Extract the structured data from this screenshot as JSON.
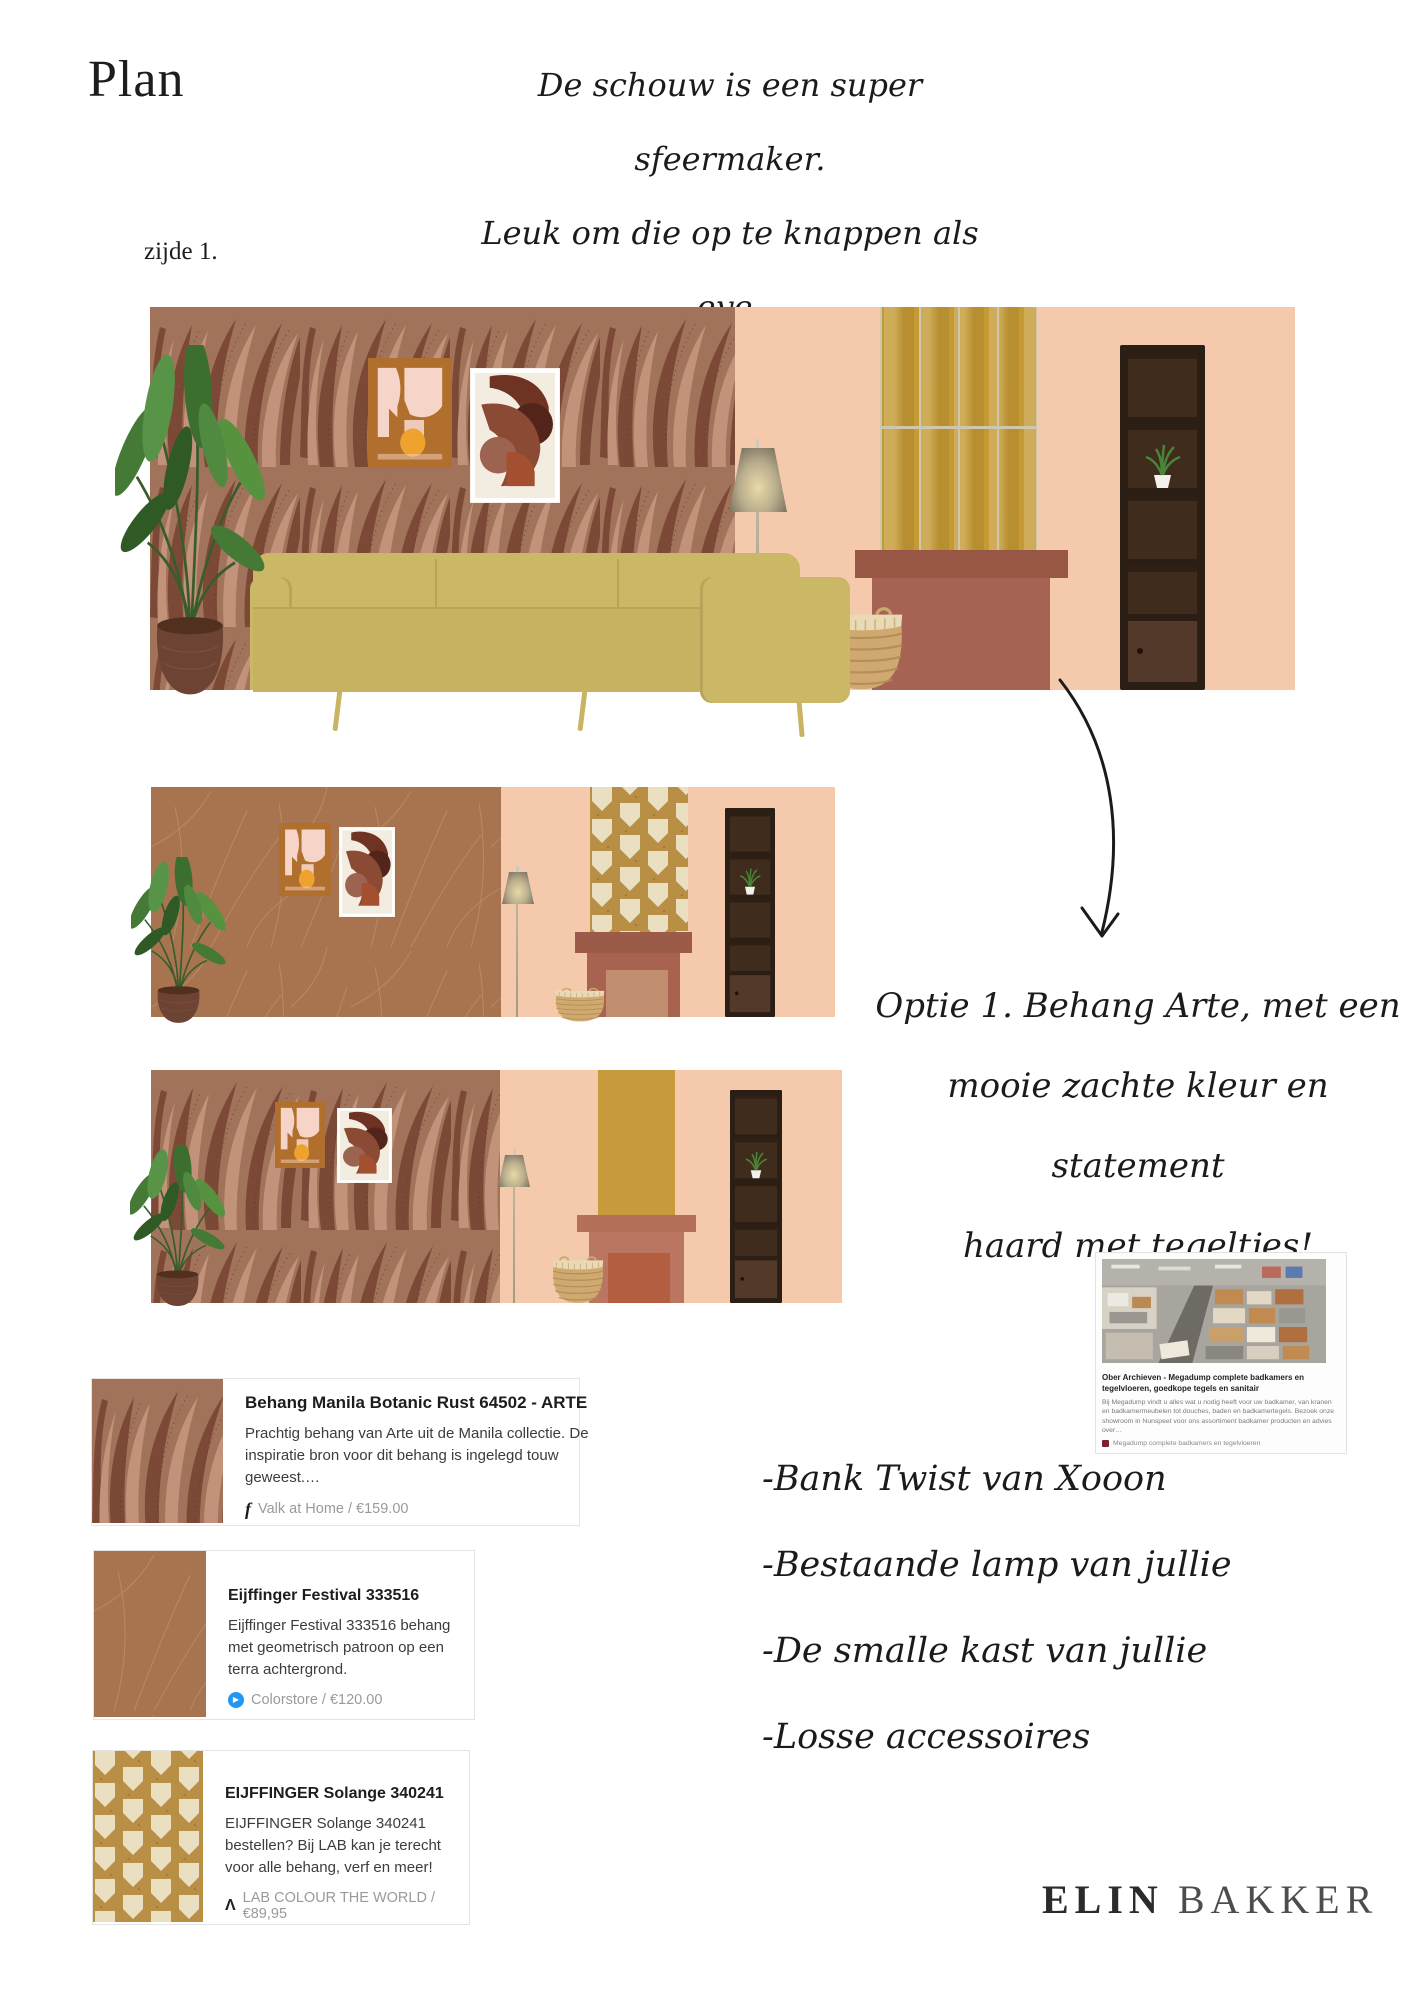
{
  "page": {
    "title": "Plan",
    "side_label": "zijde 1."
  },
  "notes": {
    "fireplace_note": {
      "lines": [
        "De schouw is een super sfeermaker.",
        "Leuk om die op te knappen als eye-",
        "catcher in de kamer!"
      ]
    },
    "option_note": {
      "lines": [
        "Optie 1. Behang Arte, met een",
        "mooie zachte kleur en statement",
        "haard met tegeltjes!"
      ]
    },
    "sourcing_list": {
      "items": [
        "-Bank Twist van Xooon",
        "-Bestaande lamp van jullie",
        "-De smalle kast van jullie",
        "-Losse accessoires"
      ]
    }
  },
  "products": [
    {
      "title": "Behang Manila Botanic Rust 64502 - ARTE",
      "description": "Prachtig behang van Arte uit de Manila collectie. De inspiratie bron voor dit behang is ingelegd touw geweest.…",
      "vendor": "Valk at Home",
      "price": "€159.00",
      "source_line": "Valk at Home / €159.00"
    },
    {
      "title": "Eijffinger Festival 333516",
      "description": "Eijffinger Festival 333516 behang met geometrisch patroon op een terra achtergrond.",
      "vendor": "Colorstore",
      "price": "€120.00",
      "source_line": "Colorstore / €120.00"
    },
    {
      "title": "EIJFFINGER Solange 340241",
      "description": "EIJFFINGER Solange 340241 bestellen? Bij LAB kan je terecht voor alle behang, verf en meer!",
      "vendor": "LAB COLOUR THE WORLD",
      "price": "€89,95",
      "source_line": "LAB COLOUR THE WORLD / €89,95"
    }
  ],
  "icons": {
    "facebook": "f",
    "colorstore": "▶",
    "lab": "Λ"
  },
  "web_snippet": {
    "title": "Ober Archieven - Megadump complete badkamers en tegelvloeren, goedkope tegels en sanitair",
    "description": "Bij Megadump vindt u alles wat u nodig heeft voor uw badkamer, van kranen en badkamermeubelen tot douches, baden en badkamertegels. Bezoek onze showroom in Nunspeet voor ons assortiment badkamer producten en advies over…",
    "source": "Megadump complete badkamers en tegelvloeren"
  },
  "brand": {
    "first_name": "ELIN",
    "last_name": "BAKKER"
  },
  "colors": {
    "peach": "#f4c9ac",
    "manila_base": "#a1735a",
    "manila_leaf_dark": "#7d4937",
    "festival_terracotta": "#a8744f",
    "solange_gold": "#b98f45",
    "tile_gold": "#c59a34",
    "fireplace_terracotta": "#9d5b49",
    "sofa_olive": "#cbb867",
    "ink": "#1b1b1b"
  }
}
